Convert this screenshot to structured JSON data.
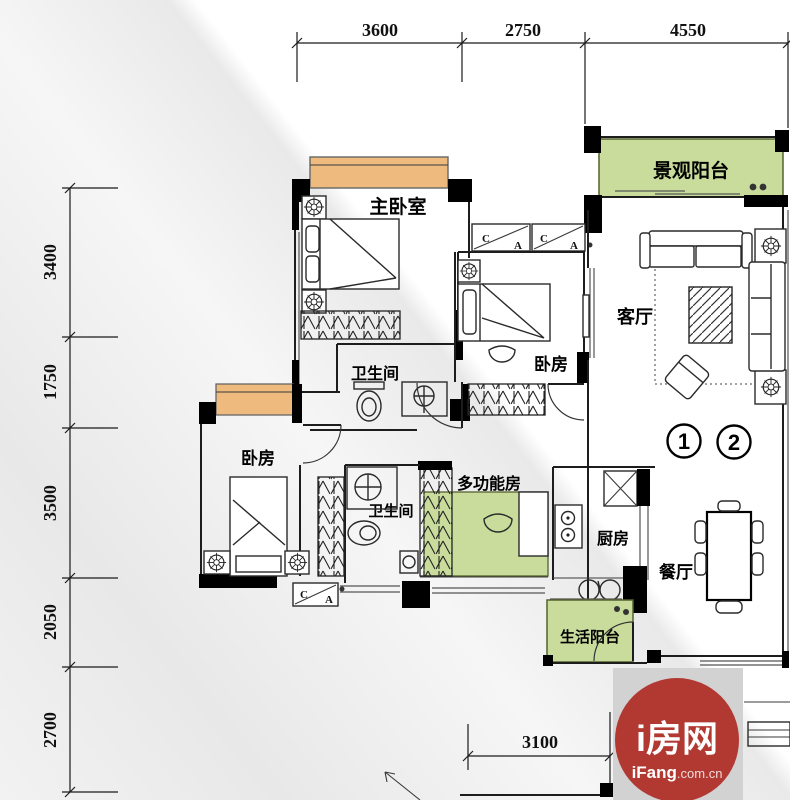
{
  "dimensions": {
    "top": [
      "3600",
      "2750",
      "4550"
    ],
    "left": [
      "3400",
      "1750",
      "3500",
      "2050",
      "2700"
    ],
    "bottom": [
      "3100"
    ]
  },
  "rooms": {
    "master_bedroom": "主卧室",
    "view_balcony": "景观阳台",
    "living_room": "客厅",
    "bedroom_mid": "卧房",
    "bathroom_main": "卫生间",
    "bedroom_left": "卧房",
    "bathroom_second": "卫生间",
    "multi_function_room": "多功能房",
    "kitchen": "厨房",
    "dining_room": "餐厅",
    "service_balcony": "生活阳台"
  },
  "markers": {
    "one": "1",
    "two": "2"
  },
  "ac_marks": {
    "c": "C",
    "a": "A"
  },
  "logo": {
    "brand": "i房网",
    "site_bold": "iFang",
    "site_rest": ".com.cn"
  },
  "colors": {
    "window_orange": "#efba7d",
    "balcony_green": "#c9dc9c",
    "logo_red": "#b23832",
    "logo_bg": "#d2d2d2",
    "wall_black": "#000000"
  }
}
